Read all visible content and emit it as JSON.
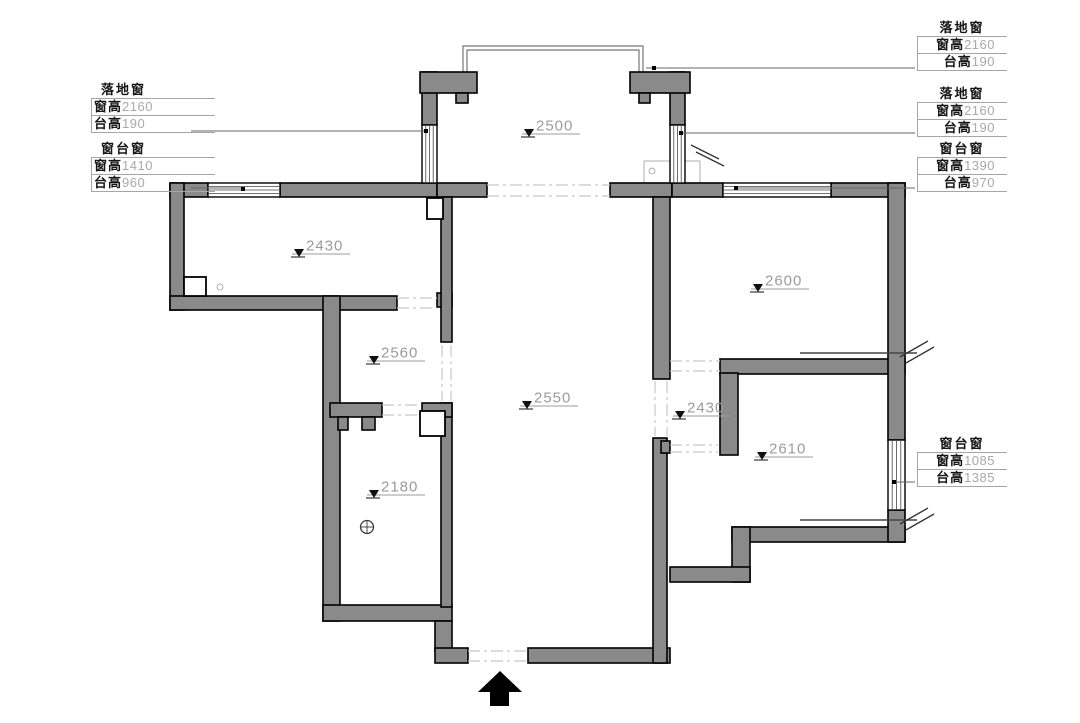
{
  "drawing": {
    "kind": "residential floor plan with ceiling heights and window specifications",
    "units": "mm"
  },
  "window_specs": [
    {
      "id": "left-floor-window",
      "title": "落地窗",
      "rows": [
        {
          "label": "窗高",
          "value": "2160"
        },
        {
          "label": "台高",
          "value": "190"
        }
      ]
    },
    {
      "id": "left-sill-window",
      "title": "窗台窗",
      "rows": [
        {
          "label": "窗高",
          "value": "1410"
        },
        {
          "label": "台高",
          "value": "960"
        }
      ]
    },
    {
      "id": "right-floor-window-1",
      "title": "落地窗",
      "rows": [
        {
          "label": "窗高",
          "value": "2160"
        },
        {
          "label": "台高",
          "value": "190"
        }
      ]
    },
    {
      "id": "right-floor-window-2",
      "title": "落地窗",
      "rows": [
        {
          "label": "窗高",
          "value": "2160"
        },
        {
          "label": "台高",
          "value": "190"
        }
      ]
    },
    {
      "id": "right-sill-window-1",
      "title": "窗台窗",
      "rows": [
        {
          "label": "窗高",
          "value": "1390"
        },
        {
          "label": "台高",
          "value": "970"
        }
      ]
    },
    {
      "id": "right-sill-window-2",
      "title": "窗台窗",
      "rows": [
        {
          "label": "窗高",
          "value": "1085"
        },
        {
          "label": "台高",
          "value": "1385"
        }
      ]
    }
  ],
  "ceiling_levels": [
    {
      "room": "balcony",
      "value": "2500"
    },
    {
      "room": "left-room",
      "value": "2430"
    },
    {
      "room": "small-room",
      "value": "2560"
    },
    {
      "room": "bathroom",
      "value": "2180"
    },
    {
      "room": "living-hall",
      "value": "2550"
    },
    {
      "room": "bedroom-top",
      "value": "2600"
    },
    {
      "room": "corridor",
      "value": "2430"
    },
    {
      "room": "bedroom-bottom",
      "value": "2610"
    }
  ],
  "colors": {
    "wall_fill": "#8a8a8a",
    "wall_outline": "#000000",
    "opening_dash": "#c8c8c8",
    "level_text": "#9b9b9b",
    "spec_label_text": "#161616",
    "spec_value_text": "#a9a9a9",
    "background": "#ffffff"
  }
}
